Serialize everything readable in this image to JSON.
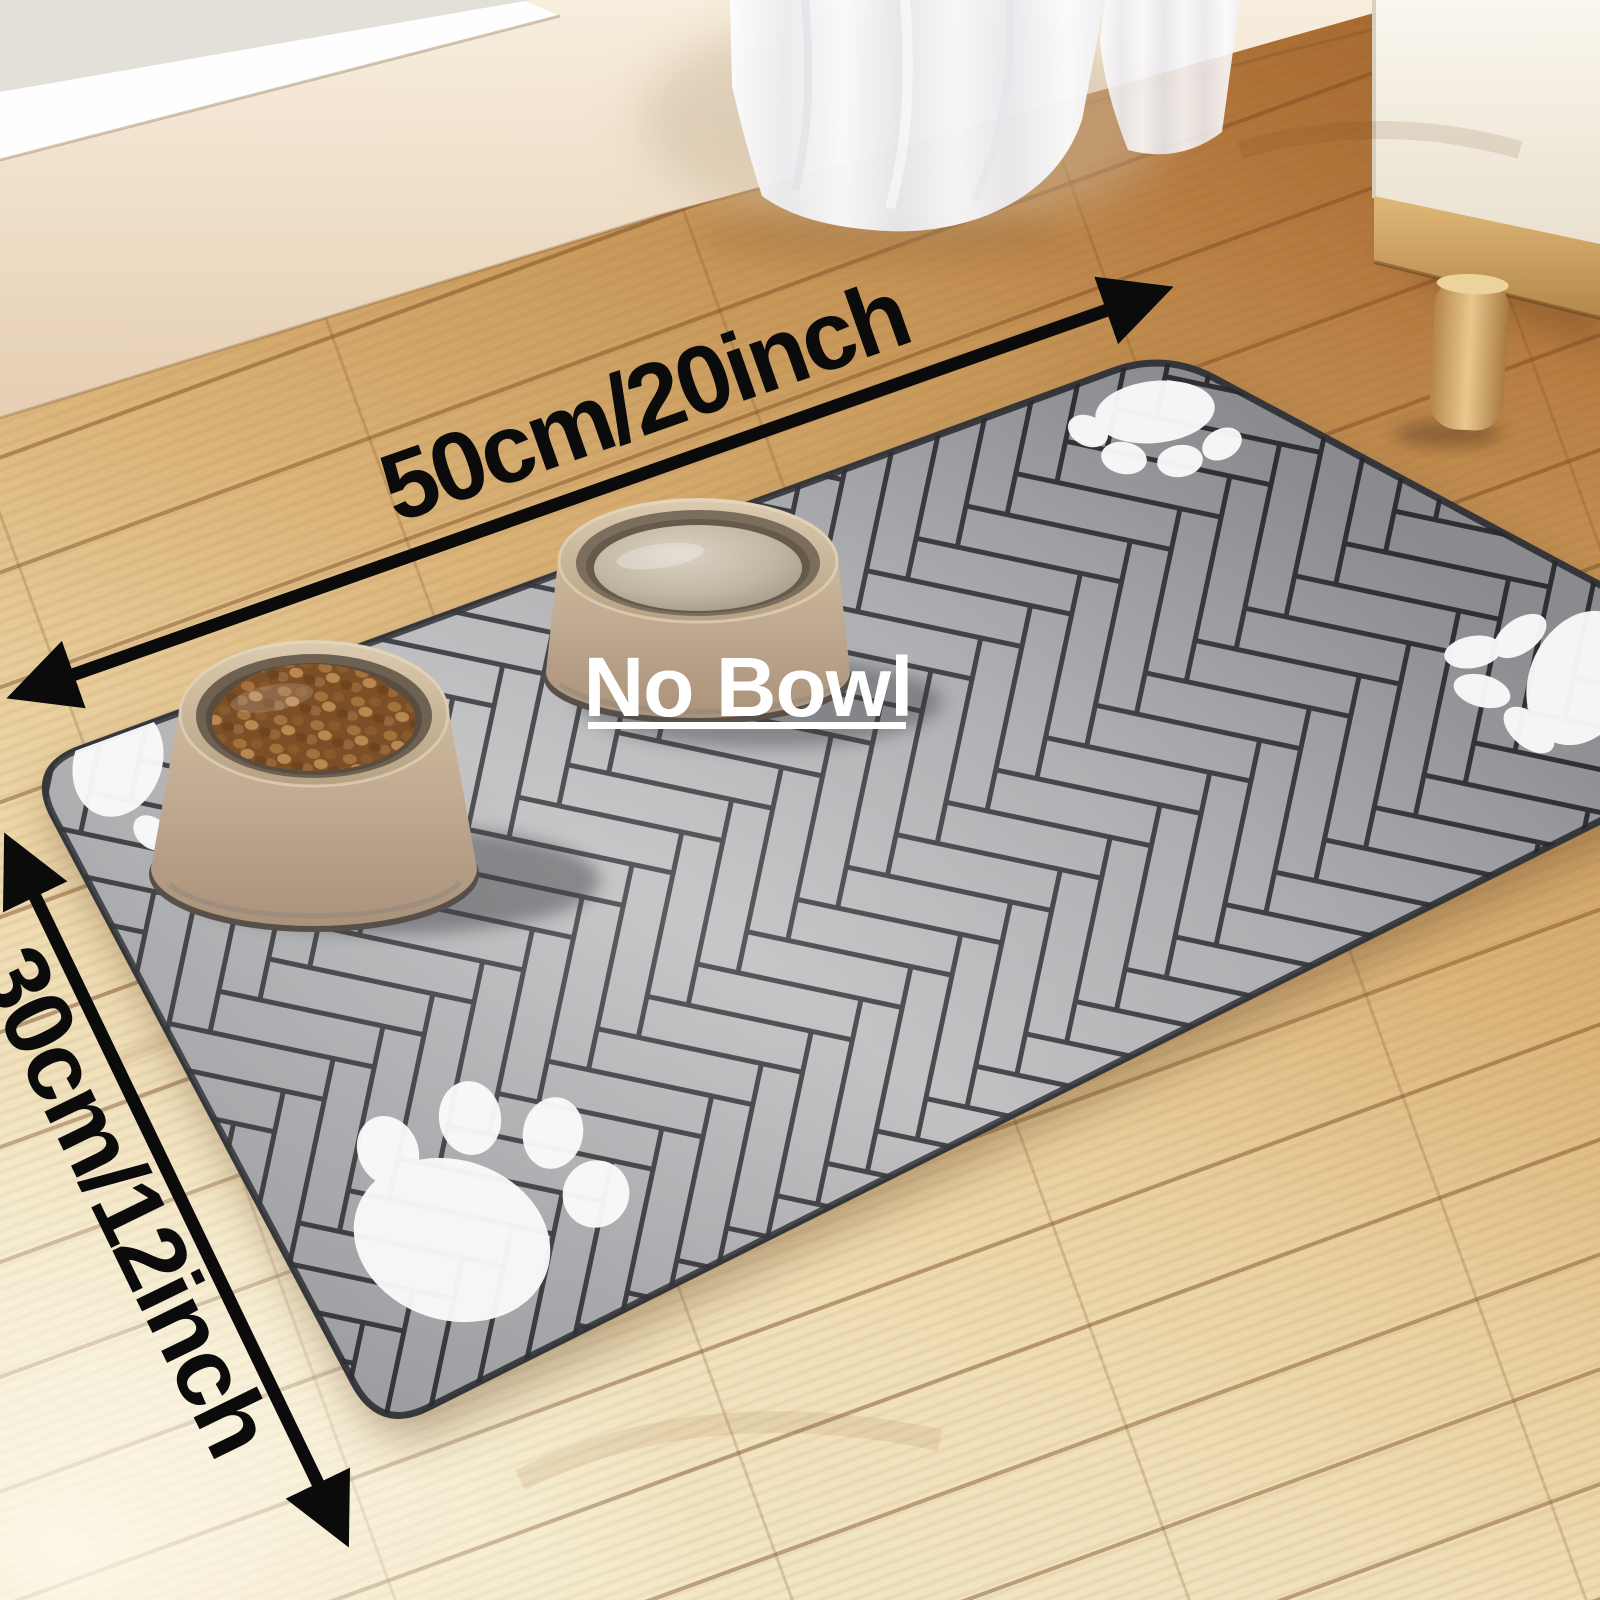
{
  "annotations": {
    "width_label": "50cm/20inch",
    "height_label": "30cm/12inch",
    "no_bowl_label": "No Bowl"
  },
  "icons": {
    "width_arrow": "double-headed-arrow-icon",
    "height_arrow": "double-headed-arrow-icon",
    "paw_prints": "paw-print-icon"
  },
  "colors": {
    "annotation_black": "#0b0b0b",
    "no_bowl_text_white": "#ffffff",
    "mat_gray": "#aaabae",
    "mat_plank_line": "#26272b",
    "mat_edge_dark": "#35363a",
    "paw_white": "#fafafa",
    "bowl_beige": "#cdb99e",
    "bowl_base_dark": "#57504a",
    "kibble_brown": "#8a5a2c",
    "water_beige": "#c9bfae",
    "floor_warm_wood": "#c08a4c",
    "floor_light_wood": "#f0e3c2",
    "wall_cream": "#eedfc9",
    "sill_white": "#fefefe",
    "cabinet_white": "#f7f2e8",
    "cabinet_wood_trim": "#c99a5c"
  }
}
